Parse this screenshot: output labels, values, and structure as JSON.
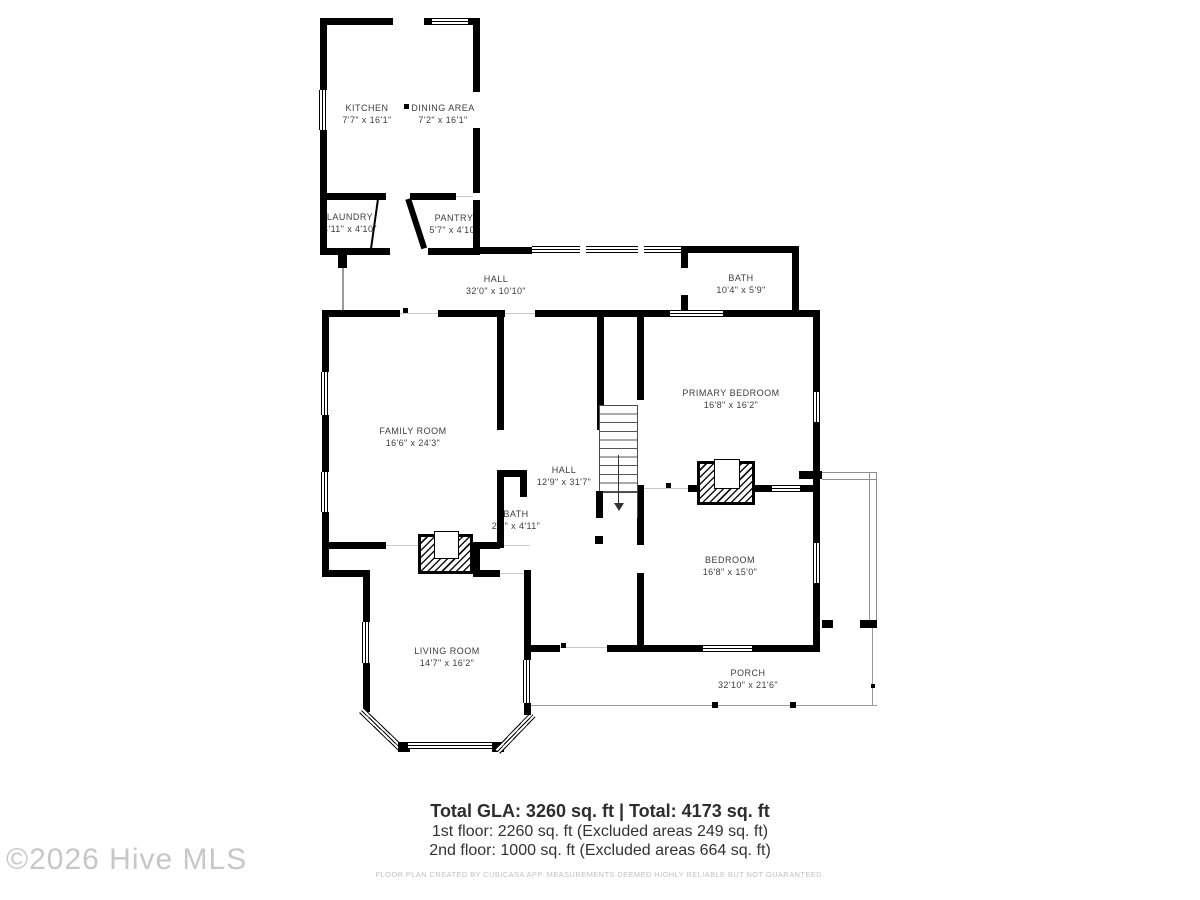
{
  "watermark": "©2026 Hive MLS",
  "rooms": [
    {
      "name": "KITCHEN",
      "dims": "7'7\" x 16'1\"",
      "x": 367,
      "y": 102
    },
    {
      "name": "DINING AREA",
      "dims": "7'2\" x 16'1\"",
      "x": 443,
      "y": 102
    },
    {
      "name": "LAUNDRY",
      "dims": "4'11\" x 4'10\"",
      "x": 350,
      "y": 211
    },
    {
      "name": "PANTRY",
      "dims": "5'7\" x 4'10\"",
      "x": 454,
      "y": 212
    },
    {
      "name": "HALL",
      "dims": "32'0\" x 10'10\"",
      "x": 496,
      "y": 273
    },
    {
      "name": "BATH",
      "dims": "10'4\" x 5'9\"",
      "x": 741,
      "y": 272
    },
    {
      "name": "FAMILY ROOM",
      "dims": "16'6\" x 24'3\"",
      "x": 413,
      "y": 425
    },
    {
      "name": "PRIMARY BEDROOM",
      "dims": "16'8\" x 16'2\"",
      "x": 731,
      "y": 387
    },
    {
      "name": "HALL",
      "dims": "12'9\" x 31'7\"",
      "x": 564,
      "y": 464
    },
    {
      "name": "BATH",
      "dims": "2'7\" x 4'11\"",
      "x": 516,
      "y": 508
    },
    {
      "name": "BEDROOM",
      "dims": "16'8\" x 15'0\"",
      "x": 730,
      "y": 554
    },
    {
      "name": "LIVING ROOM",
      "dims": "14'7\" x 16'2\"",
      "x": 447,
      "y": 645
    },
    {
      "name": "PORCH",
      "dims": "32'10\" x 21'6\"",
      "x": 748,
      "y": 667
    }
  ],
  "summary": {
    "line1": "Total GLA: 3260 sq. ft | Total: 4173 sq. ft",
    "line2": "1st floor: 2260 sq. ft (Excluded areas 249 sq. ft)",
    "line3": "2nd floor: 1000 sq. ft (Excluded areas 664 sq. ft)",
    "disclaimer": "FLOOR PLAN CREATED BY CUBICASA APP. MEASUREMENTS DEEMED HIGHLY RELIABLE BUT NOT GUARANTEED."
  },
  "colors": {
    "wall": "#000000",
    "text": "#3d3d3d",
    "muted": "#c2c2c2",
    "railing": "#8f8f8f"
  }
}
